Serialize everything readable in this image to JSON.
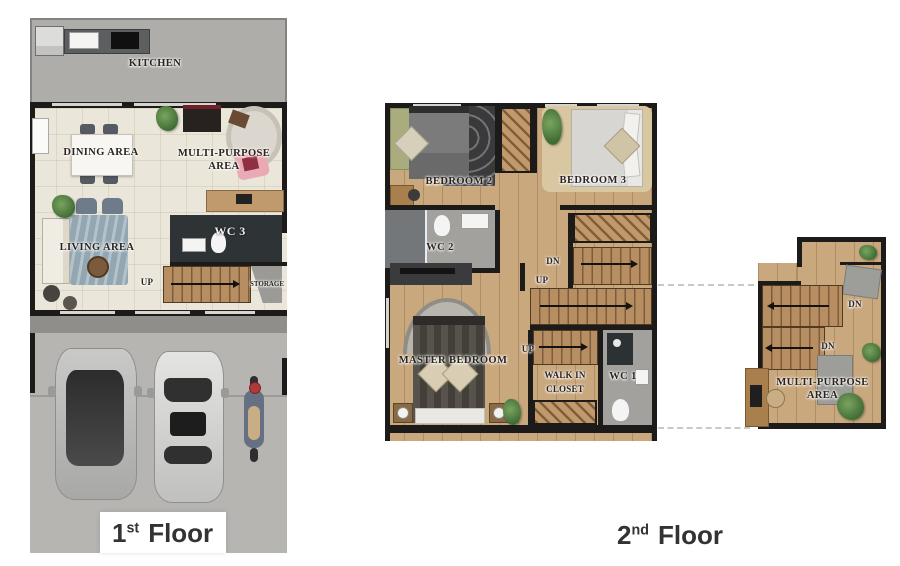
{
  "palette": {
    "wall": "#1c1b19",
    "concrete": "#aeadaa",
    "concrete-light": "#b6b5b2",
    "porch": "#8f8e8a",
    "cream": "#eae6d9",
    "wood": "#c9a87e",
    "stair": "#b78e62",
    "stair-line": "#7d5c3c",
    "hatch-wood": "#c2996b",
    "dark-room": "#2e3336",
    "wc-floor": "#a2a19e",
    "rug-dark": "#3a393b",
    "rug-tan": "#d9c7a1",
    "rug-blue": "#93a7b2",
    "pink": "#e9a9b5",
    "ink": "#2b241e",
    "caption-ink": "#333333"
  },
  "captions": {
    "floor1": {
      "num": "1",
      "sup": "st",
      "word": "Floor"
    },
    "floor2": {
      "num": "2",
      "sup": "nd",
      "word": "Floor"
    }
  },
  "floor1": {
    "kitchen": "KITCHEN",
    "dining": "DINING AREA",
    "multi1": "MULTI-PURPOSE",
    "multi2": "AREA",
    "living": "LIVING AREA",
    "wc3": "WC 3",
    "up": "UP",
    "storage": "STORAGE"
  },
  "floor2": {
    "bedroom2": "BEDROOM 2",
    "bedroom3": "BEDROOM 3",
    "wc2": "WC 2",
    "dn": "DN",
    "up1": "UP",
    "up2": "UP",
    "master": "MASTER BEDROOM",
    "walkin1": "WALK IN",
    "walkin2": "CLOSET",
    "wc1": "WC 1"
  },
  "mezzanine": {
    "dn1": "DN",
    "dn2": "DN",
    "multi1": "MULTI-PURPOSE",
    "multi2": "AREA"
  }
}
